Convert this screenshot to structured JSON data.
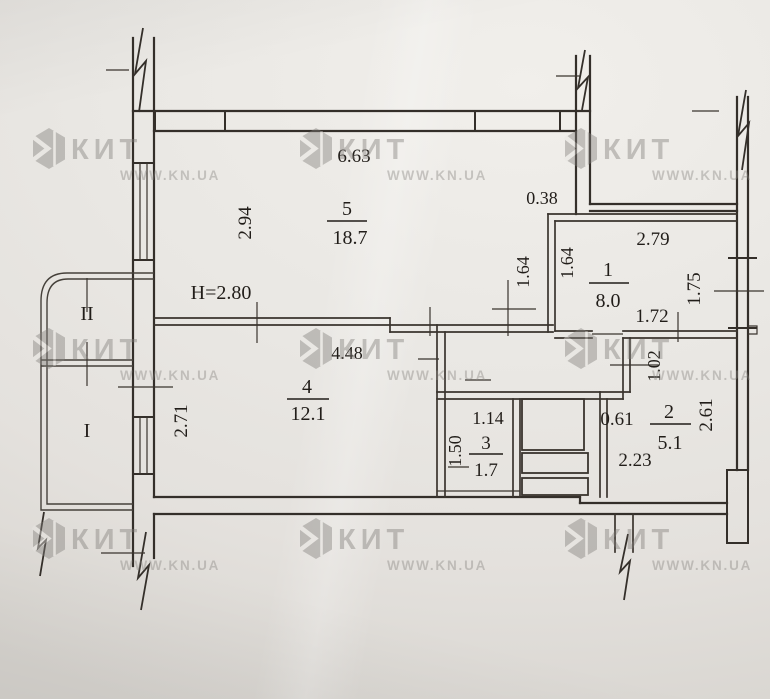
{
  "watermark": {
    "brand": "КИТ",
    "website": "WWW.KN.UA"
  },
  "floorplan": {
    "ceiling_height": "H=2.80",
    "rooms": {
      "room1": {
        "number": "1",
        "area": "8.0",
        "width": "2.79",
        "window": "1.75",
        "bottom_wall": "1.72",
        "left_wall": "1.64"
      },
      "room2": {
        "number": "2",
        "area": "5.1",
        "width": "2.23",
        "niche": "0.61",
        "upper_wall": "1.02",
        "depth": "2.61"
      },
      "room3": {
        "number": "3",
        "area": "1.7",
        "width": "1.14",
        "depth": "1.50"
      },
      "room4": {
        "number": "4",
        "area": "12.1",
        "width": "4.48",
        "depth": "2.71"
      },
      "room5": {
        "number": "5",
        "area": "18.7",
        "width": "6.63",
        "depth": "2.94",
        "right_wall": "1.64",
        "wall_step": "0.38"
      },
      "corridor": {
        "width": "2.84",
        "opening": "1.12"
      },
      "loggia_upper": {
        "number": "II"
      },
      "loggia_lower": {
        "number": "I"
      }
    }
  }
}
